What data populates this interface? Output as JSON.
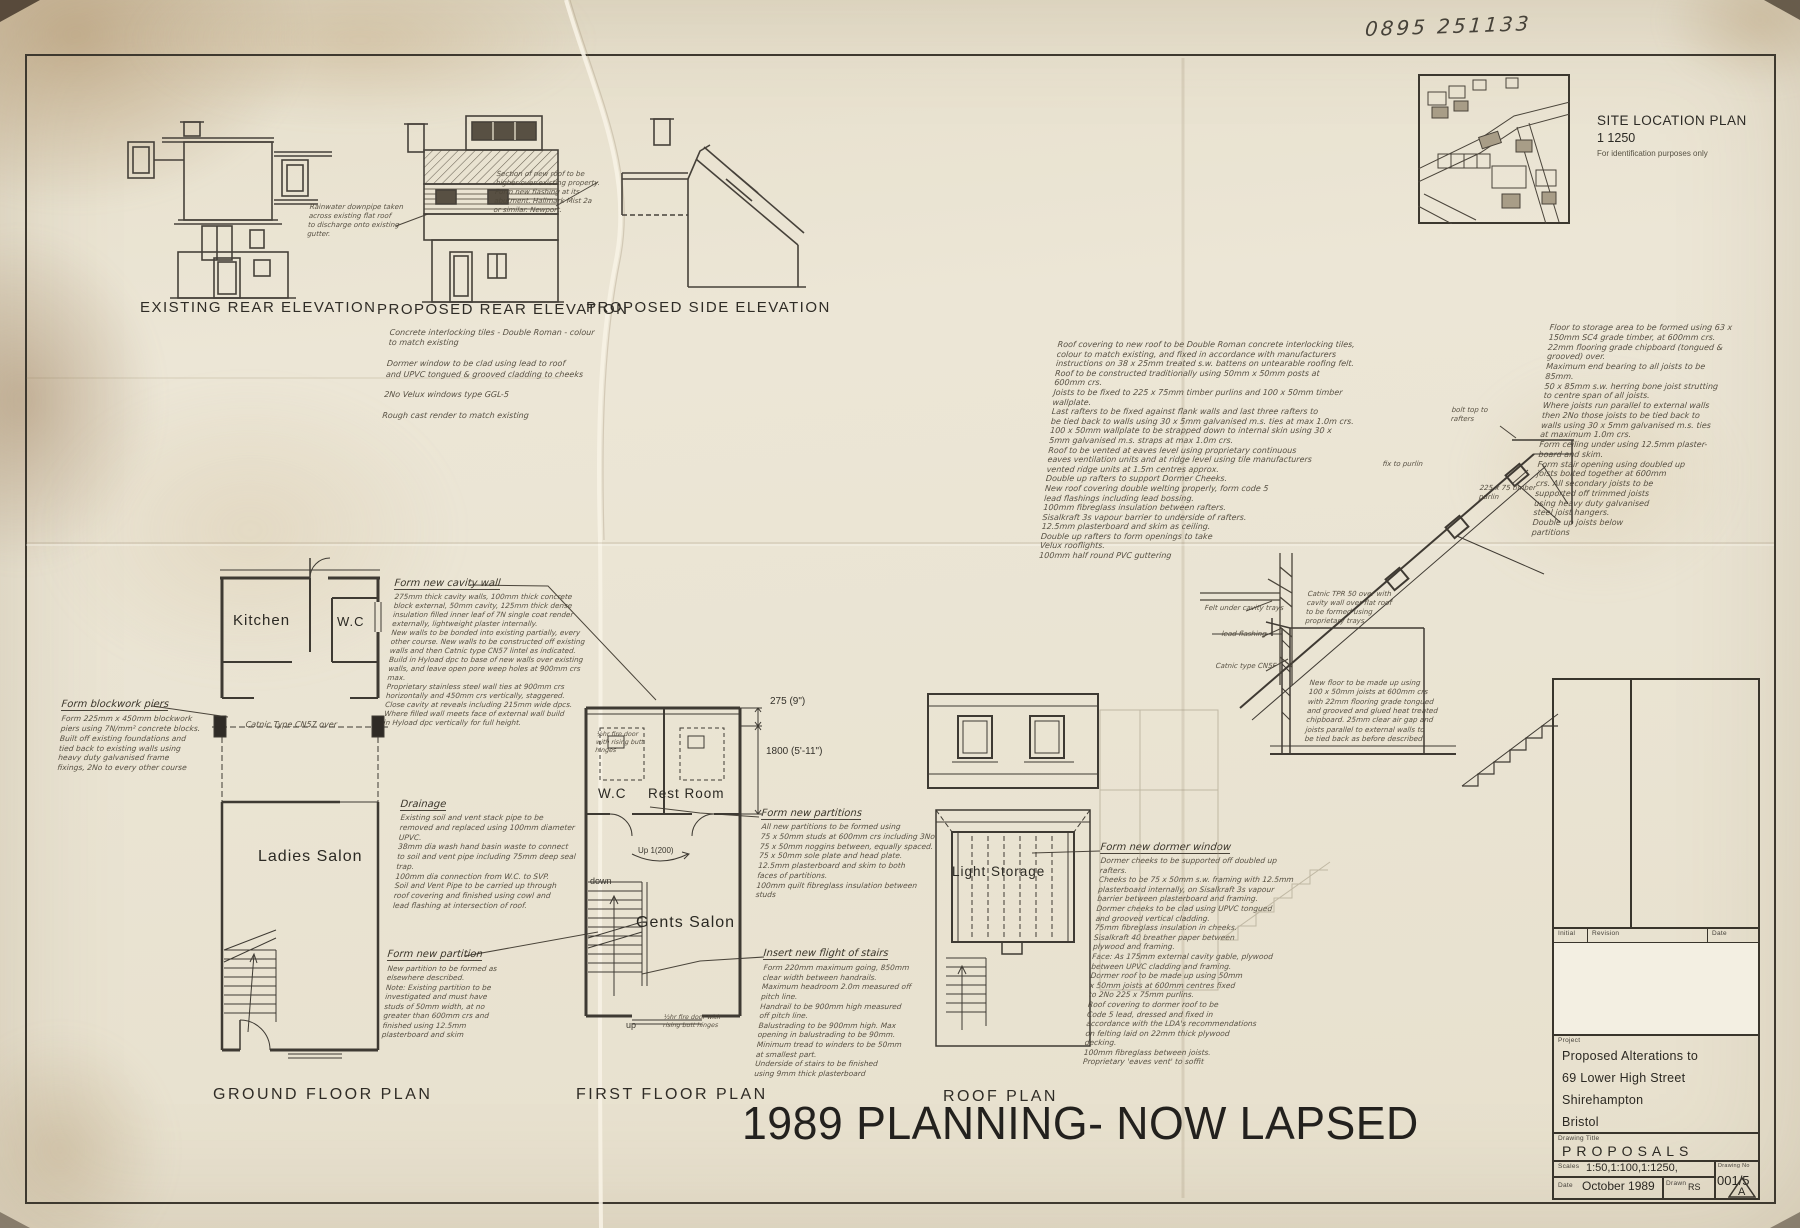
{
  "sheet": {
    "phone_number": "0895 251133",
    "overlay_text": "1989 PLANNING- NOW LAPSED"
  },
  "site_plan": {
    "title": "SITE LOCATION PLAN",
    "scale": "1 1250",
    "note": "For identification purposes only"
  },
  "elevations": {
    "existing_rear_title": "EXISTING REAR ELEVATION",
    "proposed_rear_title": "PROPOSED REAR ELEVATION",
    "proposed_side_title": "PROPOSED SIDE ELEVATION",
    "rainwater_note": "Rainwater downpipe taken\nacross existing flat roof\nto discharge onto existing\ngutter.",
    "abutment_note": "Section of new roof to be\nhigher over existing property.\nForm new flashing at its\nabutment. Hallmark Mist 2a\nor similar. Newport.",
    "proposed_rear_notes": "Concrete interlocking tiles - Double Roman - colour\nto match existing\n\nDormer window to be clad using lead to roof\nand UPVC tongued & grooved cladding to cheeks\n\n2No Velux windows type GGL-5\n\nRough cast render to match existing"
  },
  "ground_floor": {
    "title": "GROUND FLOOR PLAN",
    "kitchen": "Kitchen",
    "wc": "W.C",
    "salon": "Ladies Salon",
    "lintel_note": "Catnic Type CN57 over",
    "blockwork_title": "Form blockwork piers",
    "blockwork_body": "Form 225mm x 450mm blockwork\npiers using 7N/mm² concrete blocks.\nBuilt off existing foundations and\ntied back to existing walls using\nheavy duty galvanised frame\nfixings, 2No to every other course"
  },
  "first_floor": {
    "title": "FIRST FLOOR PLAN",
    "wc": "W.C",
    "rest_room": "Rest Room",
    "salon": "Gents Salon",
    "down": "down",
    "up": "up",
    "up_going": "Up 1(200)",
    "dim_parapet": "275 (9\")",
    "dim_room": "1800 (5'-11\")",
    "fire_door_note": "½hr fire door\nwith rising butt\nhinges",
    "fire_door_note2": "½hr fire door with\nrising butt hinges"
  },
  "roof_plan": {
    "title": "ROOF PLAN",
    "room": "Light Storage"
  },
  "notes": {
    "cavity_wall_title": "Form new cavity wall",
    "cavity_wall_body": "275mm thick cavity walls, 100mm thick concrete\nblock external, 50mm cavity, 125mm thick dense\ninsulation filled inner leaf of 7N single coat render\nexternally, lightweight plaster internally.\nNew walls to be bonded into existing partially, every\nother course. New walls to be constructed off existing\nwalls and then Catnic type CN57 lintel as indicated.\nBuild in Hyload dpc to base of new walls over existing\nwalls, and leave open pore weep holes at 900mm crs max.\nProprietary stainless steel wall ties at 900mm crs\nhorizontally and 450mm crs vertically, staggered.\nClose cavity at reveals including 215mm wide dpcs.\nWhere filled wall meets face of external wall build\nin Hyload dpc vertically for full height.",
    "drainage_title": "Drainage",
    "drainage_body": "Existing soil and vent stack pipe to be\nremoved and replaced using 100mm diameter\nUPVC.\n38mm dia wash hand basin waste to connect\nto soil and vent pipe including 75mm deep seal\ntrap.\n100mm dia connection from W.C. to SVP.\nSoil and Vent Pipe to be carried up through\nroof covering and finished using cowl and\nlead flashing at intersection of roof.",
    "partition_title": "Form new partition",
    "partition_body": "New partition to be formed as\nelsewhere described.\nNote: Existing partition to be\ninvestigated and must have\nstuds of 50mm width, at no\ngreater than 600mm crs and\nfinished using 12.5mm\nplasterboard and skim",
    "partitions_title": "Form new partitions",
    "partitions_body": "All new partitions to be formed using\n75 x 50mm studs at 600mm crs including 3No\n75 x 50mm noggins between, equally spaced.\n75 x 50mm sole plate and head plate.\n12.5mm plasterboard and skim to both\nfaces of partitions.\n100mm quilt fibreglass insulation between\nstuds",
    "stairs_title": "Insert new flight of stairs",
    "stairs_body": "Form 220mm maximum going, 850mm\nclear width between handrails.\nMaximum headroom 2.0m measured off\npitch line.\nHandrail to be 900mm high measured\noff pitch line.\nBalustrading to be 900mm high. Max\nopening in balustrading to be 90mm.\nMinimum tread to winders to be 50mm\nat smallest part.\nUnderside of stairs to be finished\nusing 9mm thick plasterboard",
    "dormer_title": "Form new dormer window",
    "dormer_body": "Dormer cheeks to be supported off doubled up\nrafters.\nCheeks to be 75 x 50mm s.w. framing with 12.5mm\nplasterboard internally, on Sisalkraft 3s vapour\nbarrier between plasterboard and framing.\nDormer cheeks to be clad using UPVC tongued\nand grooved vertical cladding.\n75mm fibreglass insulation in cheeks.\nSisalkraft 40 breather paper between\nplywood and framing.\nFace: As 175mm external cavity gable, plywood\nbetween UPVC cladding and framing.\nDormer roof to be made up using 50mm\nx 50mm joists at 600mm centres fixed\nto 2No 225 x 75mm purlins.\nRoof covering to dormer roof to be\nCode 5 lead, dressed and fixed in\naccordance with the LDA's recommendations\non felting laid on 22mm thick plywood\ndecking.\n100mm fibreglass between joists.\nProprietary 'eaves vent' to soffit",
    "roof_spec": "Roof covering to new roof to be Double Roman concrete interlocking tiles,\ncolour to match existing, and fixed in accordance with manufacturers\ninstructions on 38 x 25mm treated s.w. battens on untearable roofing felt.\nRoof to be constructed traditionally using 50mm x 50mm posts at\n600mm crs.\nJoists to be fixed to 225 x 75mm timber purlins and 100 x 50mm timber\nwallplate.\nLast rafters to be fixed against flank walls and last three rafters to\nbe tied back to walls using 30 x 5mm galvanised m.s. ties at max 1.0m crs.\n100 x 50mm wallplate to be strapped down to internal skin using 30 x\n5mm galvanised m.s. straps at max 1.0m crs.\nRoof to be vented at eaves level using proprietary continuous\neaves ventilation units and at ridge level using tile manufacturers\nvented ridge units at 1.5m centres approx.\nDouble up rafters to support Dormer Cheeks.\nNew roof covering double welting properly, form code 5\nlead flashings including lead bossing.\n100mm fibreglass insulation between rafters.\nSisalkraft 3s vapour barrier to underside of rafters.\n12.5mm plasterboard and skim as ceiling.\nDouble up rafters to form openings to take\nVelux rooflights.\n100mm half round PVC guttering",
    "floor_spec": "Floor to storage area to be formed using 63 x\n150mm SC4 grade timber, at 600mm crs.\n22mm flooring grade chipboard (tongued &\ngrooved) over.\nMaximum end bearing to all joists to be\n85mm.\n50 x 85mm s.w. herring bone joist strutting\nto centre span of all joists.\nWhere joists run parallel to external walls\nthen 2No those joists to be tied back to\nwalls using 30 x 5mm galvanised m.s. ties\nat maximum 1.0m crs.\nForm ceiling under using 12.5mm plaster-\nboard and skim.\nForm stair opening using doubled up\njoists bolted together at 600mm\ncrs. All secondary joists to be\nsupported off trimmed joists\nusing heavy duty galvanised\nsteel joist hangers.\nDouble up joists below\npartitions"
  },
  "section": {
    "bolt_note": "bolt top to\nrafters",
    "fix_purlin_note": "fix to purlin",
    "purlin_note": "225 x 75 timber\npurlin",
    "felt_note": "Felt under cavity trays",
    "flashing_note": "lead flashing",
    "catnic_note": "Catnic type CN5F",
    "cavity_tray_note": "Catnic TPR 50 over with\ncavity wall over flat roof\nto be formed using\nproprietary trays",
    "new_floor_note": "New floor to be made up using\n100 x 50mm joists at 600mm crs\nwith 22mm flooring grade tongued\nand grooved and glued heat treated\nchipboard. 25mm clear air gap and\njoists parallel to external walls to\nbe tied back as before described"
  },
  "title_block": {
    "initial_label": "Initial",
    "revision_label": "Revision",
    "date_col_label": "Date",
    "project_label": "Project",
    "project_line1": "Proposed Alterations to",
    "project_line2": "69 Lower High Street",
    "project_line3": "Shirehampton",
    "project_line4": "Bristol",
    "drawing_title_label": "Drawing Title",
    "drawing_title": "PROPOSALS",
    "scales_label": "Scales",
    "scales_value": "1:50,1:100,1:1250,",
    "date_label": "Date",
    "date_value": "October 1989",
    "drawn_label": "Drawn",
    "drawn_value": "RS",
    "drawing_no_label": "Drawing No",
    "drawing_no_value": "001/5",
    "revision_letter": "A"
  }
}
